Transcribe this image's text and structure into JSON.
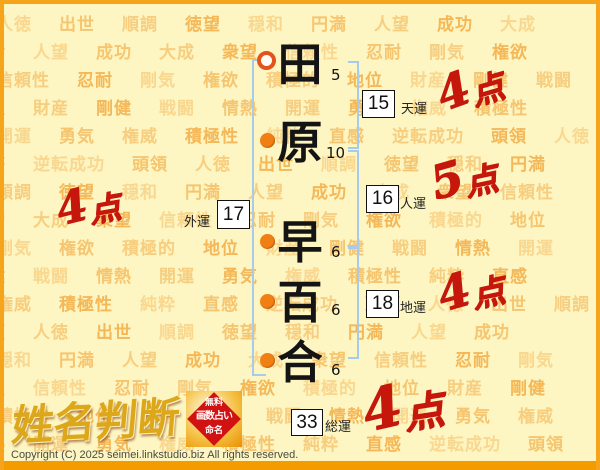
{
  "page": {
    "background_words": [
      "人徳",
      "出世",
      "順調",
      "徳望",
      "穏和",
      "円満",
      "人望",
      "成功",
      "大成",
      "衆望",
      "信頼性",
      "忍耐",
      "剛気",
      "権欲",
      "積極的",
      "地位",
      "財産",
      "剛健",
      "戦闘",
      "情熱",
      "開運",
      "勇気",
      "権威",
      "積極性",
      "純粋",
      "直感",
      "逆転成功",
      "頭領"
    ]
  },
  "name": {
    "characters": [
      {
        "char": "田",
        "strokes": "5"
      },
      {
        "char": "原",
        "strokes": "10"
      },
      {
        "char": "早",
        "strokes": "6"
      },
      {
        "char": "百",
        "strokes": "6"
      },
      {
        "char": "合",
        "strokes": "6"
      }
    ]
  },
  "fortunes": {
    "ten": {
      "label": "天運",
      "value": "15",
      "score_num": "4",
      "score_unit": "点"
    },
    "jin": {
      "label": "人運",
      "value": "16",
      "score_num": "5",
      "score_unit": "点"
    },
    "gai": {
      "label": "外運",
      "value": "17",
      "score_num": "4",
      "score_unit": "点"
    },
    "chi": {
      "label": "地運",
      "value": "18",
      "score_num": "4",
      "score_unit": "点"
    },
    "sou": {
      "label": "総運",
      "value": "33",
      "score_num": "4",
      "score_unit": "点"
    }
  },
  "logo": {
    "title": "姓名判断",
    "seal": {
      "line1": "無料",
      "line2": "画数占い",
      "line3": "命名"
    }
  },
  "footer": {
    "copyright": "Copyright (C) 2025 seimei.linkstudio.biz All rights reserved."
  },
  "colors": {
    "accent_orange": "#f6a41c",
    "score_red": "#c5170c",
    "bracket_blue": "#a7cbec",
    "watermark_orange": "#f3a93e",
    "background": "#fdf5c2",
    "seal_red": "#d01212"
  }
}
